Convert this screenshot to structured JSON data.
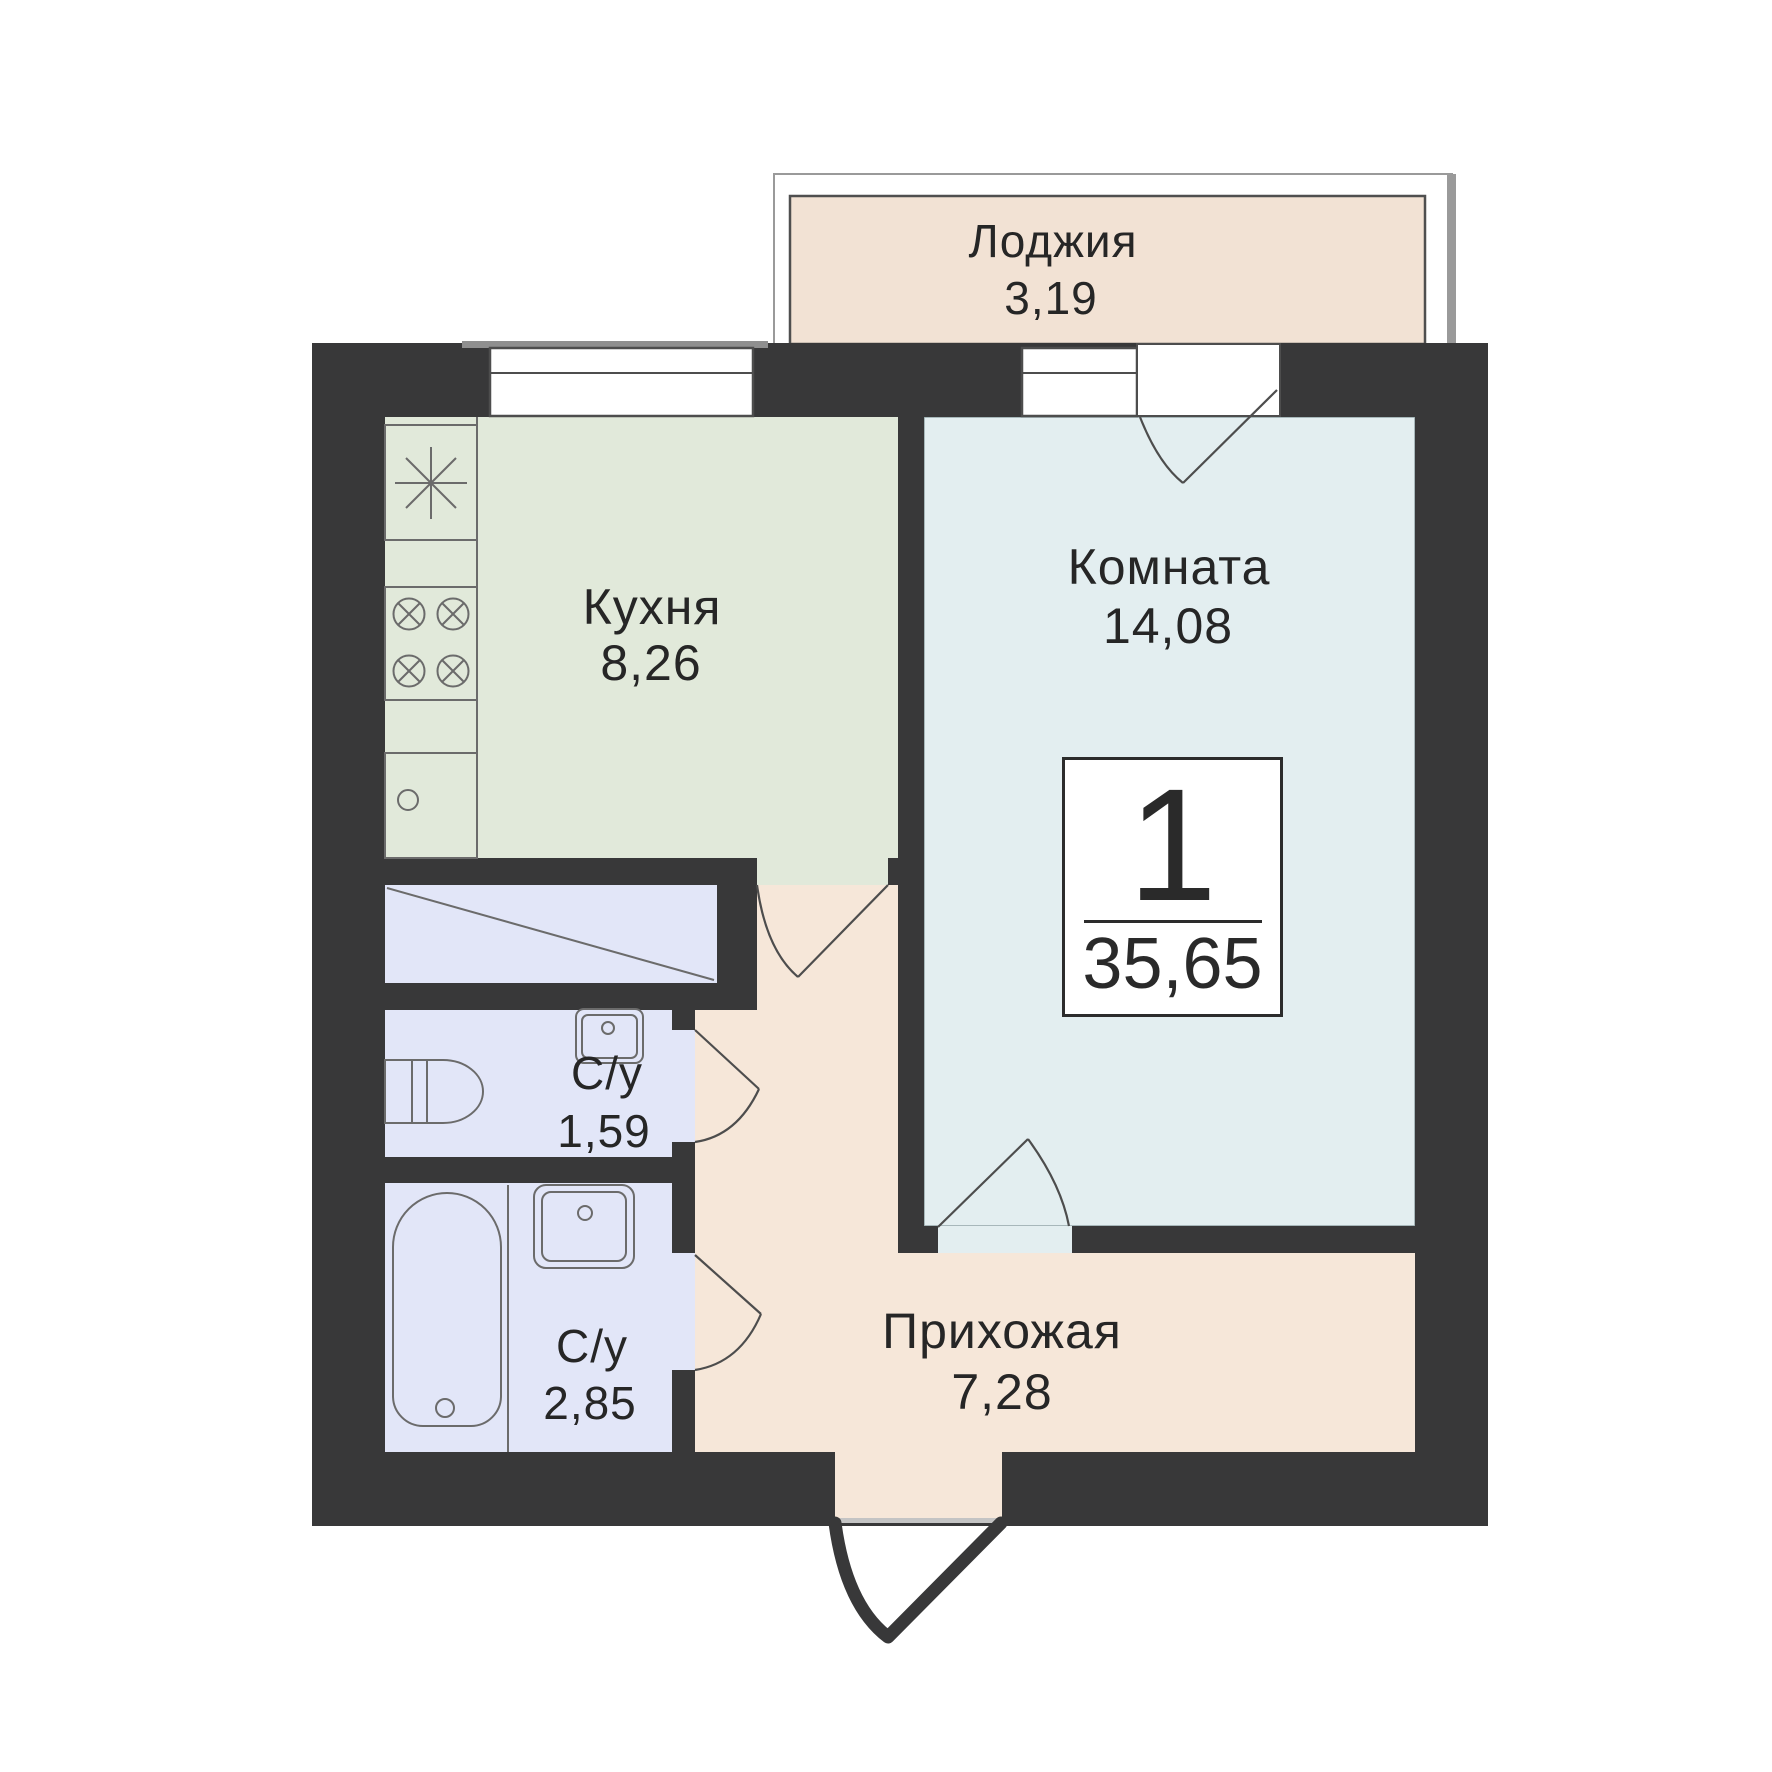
{
  "plan": {
    "type": "apartment-floor-plan",
    "badge": {
      "rooms_count": "1",
      "total_area": "35,65"
    },
    "rooms": [
      {
        "id": "loggia",
        "name": "Лоджия",
        "area": "3,19"
      },
      {
        "id": "kitchen",
        "name": "Кухня",
        "area": "8,26"
      },
      {
        "id": "living-room",
        "name": "Комната",
        "area": "14,08"
      },
      {
        "id": "bathroom-small",
        "name": "С/у",
        "area": "1,59"
      },
      {
        "id": "bathroom-large",
        "name": "С/у",
        "area": "2,85"
      },
      {
        "id": "hallway",
        "name": "Прихожая",
        "area": "7,28"
      }
    ],
    "colors": {
      "wall": "#383839",
      "kitchen_floor": "#e1e9da",
      "room_floor": "#e3eef0",
      "bathroom_floor": "#e2e6f8",
      "hallway_floor": "#f6e7d9",
      "loggia_floor": "#f2e2d4",
      "fixture_line": "#6b6b6b",
      "door_line": "#4d4d4d",
      "text": "#262626"
    },
    "icons": [
      "fridge-icon",
      "stove-icon",
      "kitchen-sink-icon",
      "toilet-icon",
      "washbasin-icon",
      "bathtub-icon",
      "window-icon",
      "door-arc-icon",
      "entrance-door-icon"
    ]
  }
}
